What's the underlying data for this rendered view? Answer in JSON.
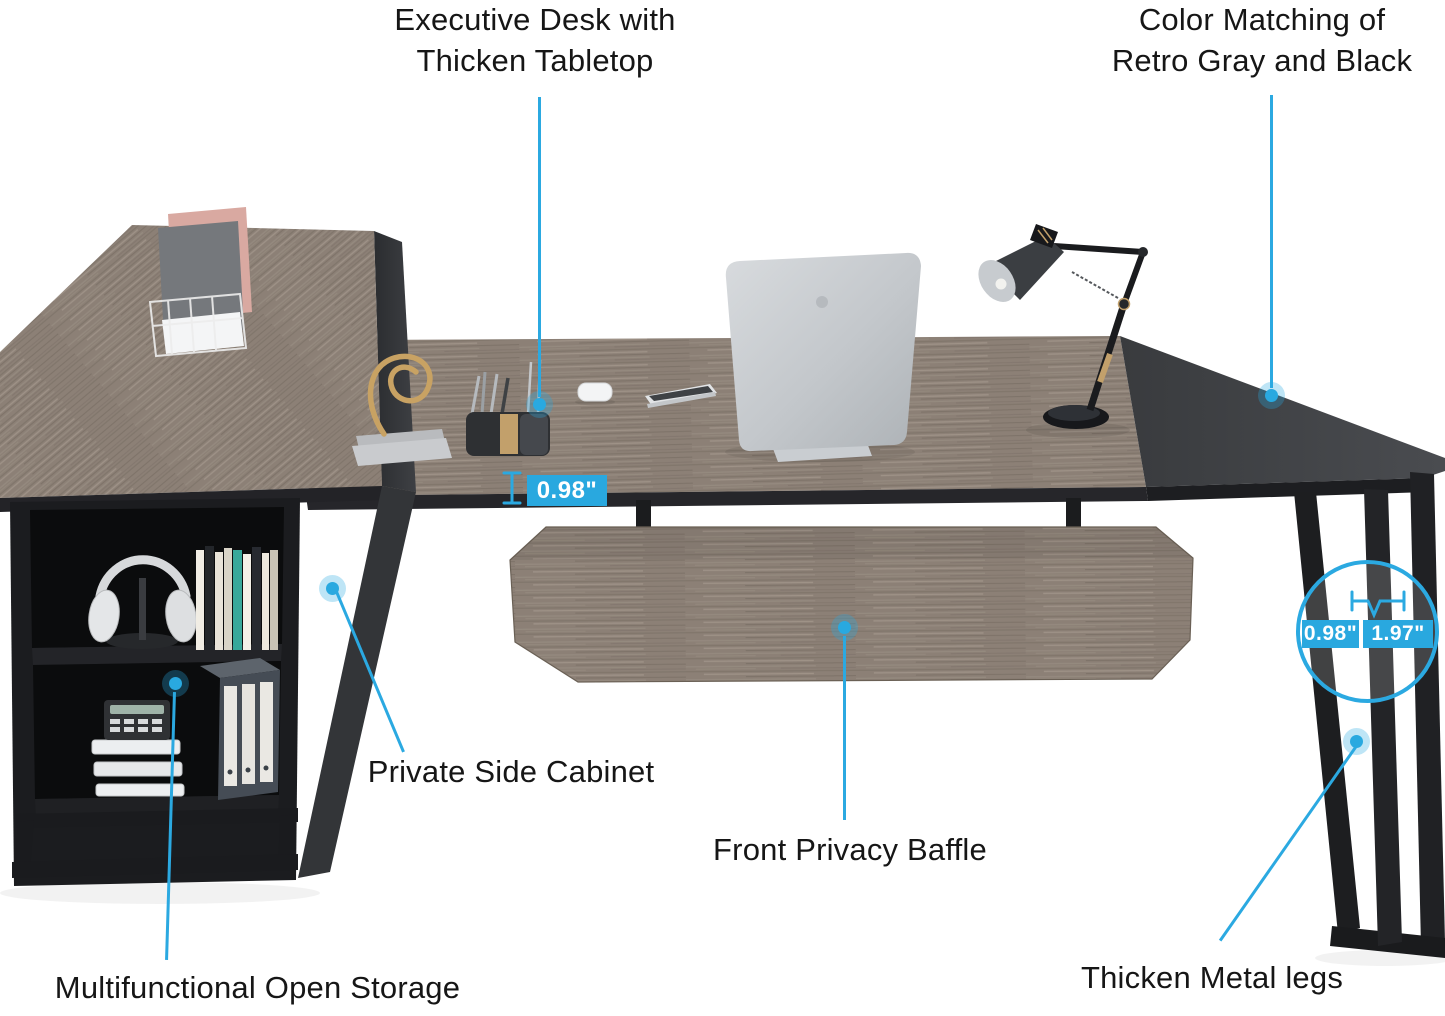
{
  "colors": {
    "accent": "#2BA9E1",
    "wood": "#8C8076",
    "wood_dark": "#6F655B",
    "cabinet_black": "#1B1C1E",
    "desktop_dark": "#404245"
  },
  "annotations": {
    "executive_desk": {
      "line1": "Executive Desk with",
      "line2": "Thicken Tabletop"
    },
    "color_matching": {
      "line1": "Color Matching of",
      "line2": "Retro Gray and Black"
    },
    "private_side_cabinet": {
      "label": "Private Side Cabinet"
    },
    "front_privacy_baffle": {
      "label": "Front Privacy Baffle"
    },
    "multifunctional_open_storage": {
      "label": "Multifunctional Open Storage"
    },
    "thicken_metal_legs": {
      "label": "Thicken Metal legs"
    }
  },
  "measurements": {
    "tabletop_thickness": "0.98\"",
    "leg_width": "0.98\"",
    "leg_depth": "1.97\""
  },
  "icons": {
    "thickness_icon": "i-beam-height-measure",
    "leg_dimension_icon": "width-dimension-marks"
  }
}
